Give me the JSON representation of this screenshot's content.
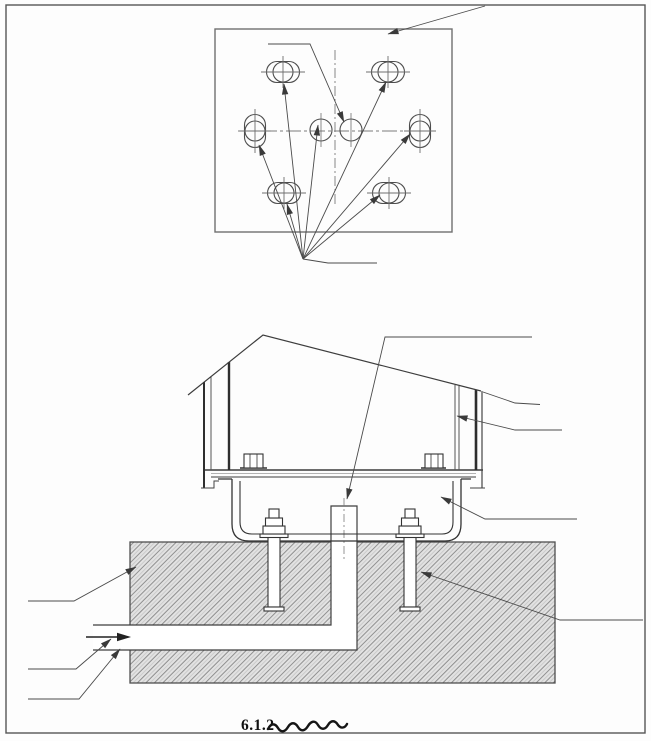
{
  "figure": {
    "caption_number": "6.1.2"
  },
  "colors": {
    "line": "#3d3d3d",
    "line_heavy": "#2e2e2e",
    "line_light": "#707070",
    "leader": "#4a4a4a",
    "hatch_line": "#8f8f8f",
    "hatch_bg": "#e2e2e2",
    "border": "#565656",
    "text": "#111111"
  }
}
